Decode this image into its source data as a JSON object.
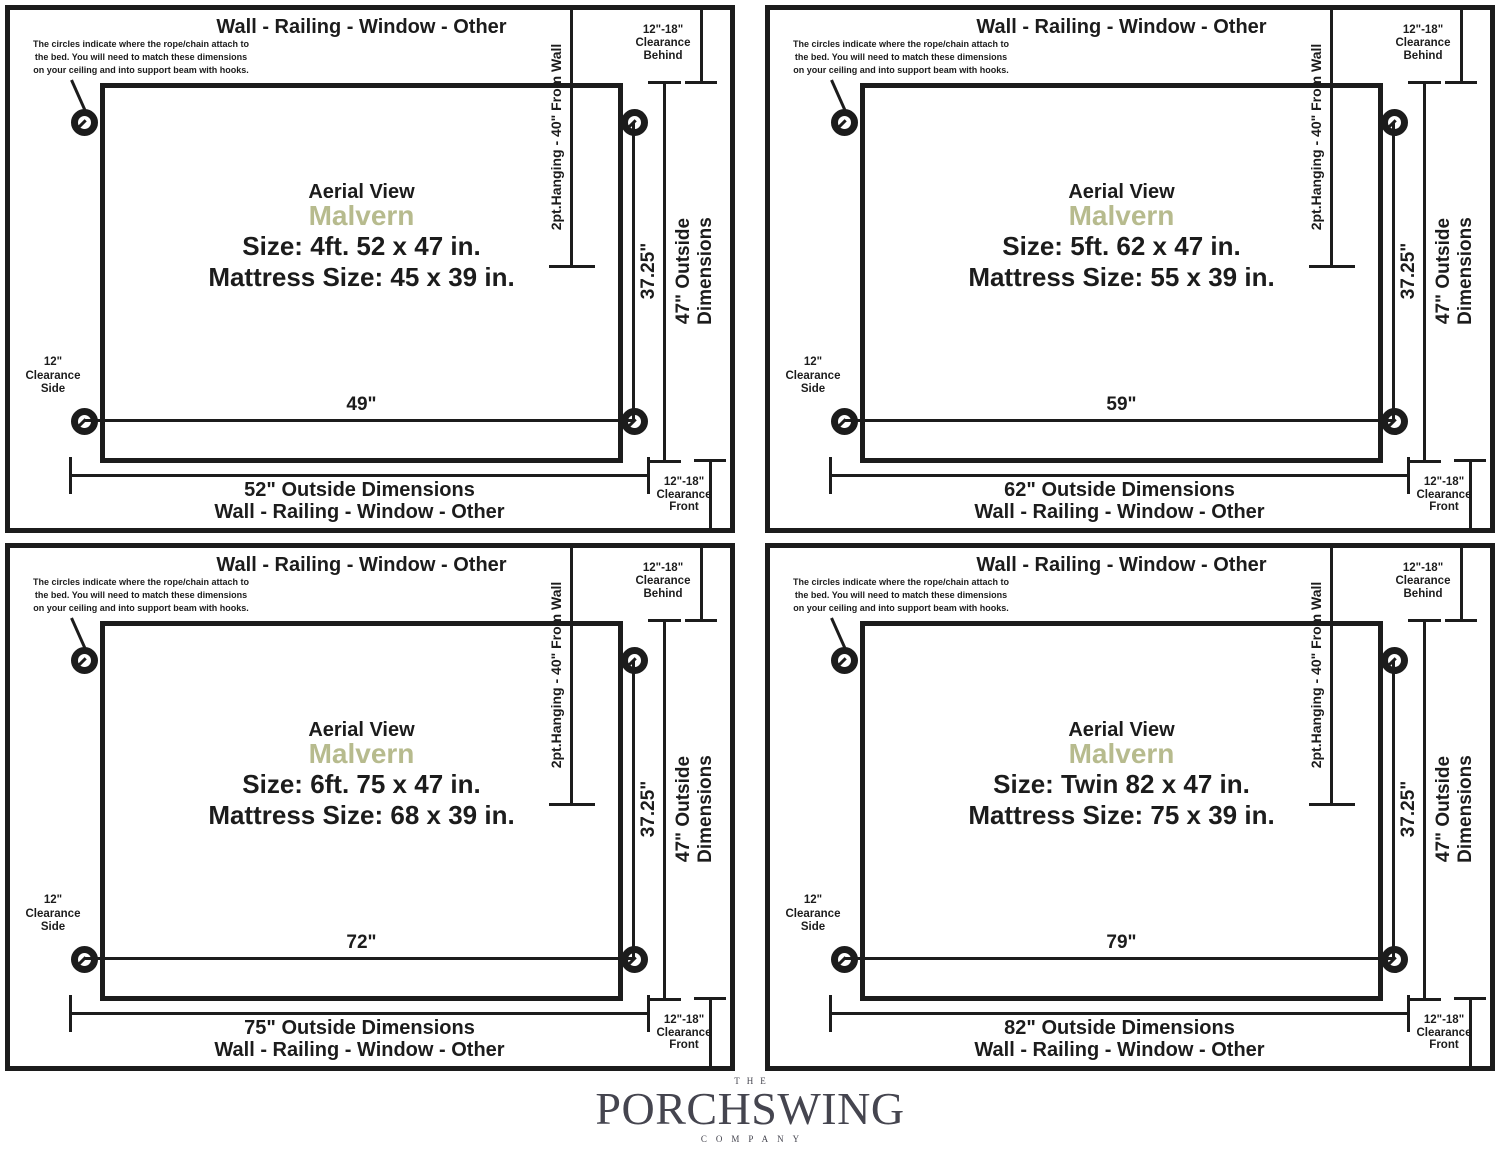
{
  "shared": {
    "wall_label": "Wall - Railing - Window - Other",
    "note_lines": [
      "The circles indicate where the rope/chain attach to",
      "the bed. You will need to match these dimensions",
      "on your ceiling and into support beam with hooks."
    ],
    "hang_label": "2pt.Hanging - 40\" From Wall",
    "hang_depth_label": "37.25\"",
    "outside_depth_line1": "47\" Outside",
    "outside_depth_line2": "Dimensions",
    "clearance_behind_lines": [
      "12\"-18\"",
      "Clearance",
      "Behind"
    ],
    "clearance_front_lines": [
      "12\"-18\"",
      "Clearance",
      "Front"
    ],
    "clearance_side_lines": [
      "12\"",
      "Clearance",
      "Side"
    ],
    "aerial_label": "Aerial View",
    "model_name": "Malvern",
    "colors": {
      "accent_olive": "#b7bb8e",
      "ink": "#1c1c1c",
      "logo_gray": "#45454f"
    }
  },
  "panels": [
    {
      "size_label": "Size: 4ft. 52 x 47 in.",
      "mattress_label": "Mattress Size: 45 x 39 in.",
      "hang_width_label": "49\"",
      "outside_width_label": "52\" Outside Dimensions"
    },
    {
      "size_label": "Size: 5ft. 62 x 47 in.",
      "mattress_label": "Mattress Size: 55 x 39 in.",
      "hang_width_label": "59\"",
      "outside_width_label": "62\" Outside Dimensions"
    },
    {
      "size_label": "Size: 6ft. 75 x 47 in.",
      "mattress_label": "Mattress Size: 68 x 39 in.",
      "hang_width_label": "72\"",
      "outside_width_label": "75\" Outside Dimensions"
    },
    {
      "size_label": "Size: Twin 82 x 47 in.",
      "mattress_label": "Mattress Size: 75 x 39 in.",
      "hang_width_label": "79\"",
      "outside_width_label": "82\" Outside Dimensions"
    }
  ],
  "footer": {
    "the_label": "THE",
    "brand_name": "PORCHSWING",
    "company_label": "COMPANY"
  }
}
